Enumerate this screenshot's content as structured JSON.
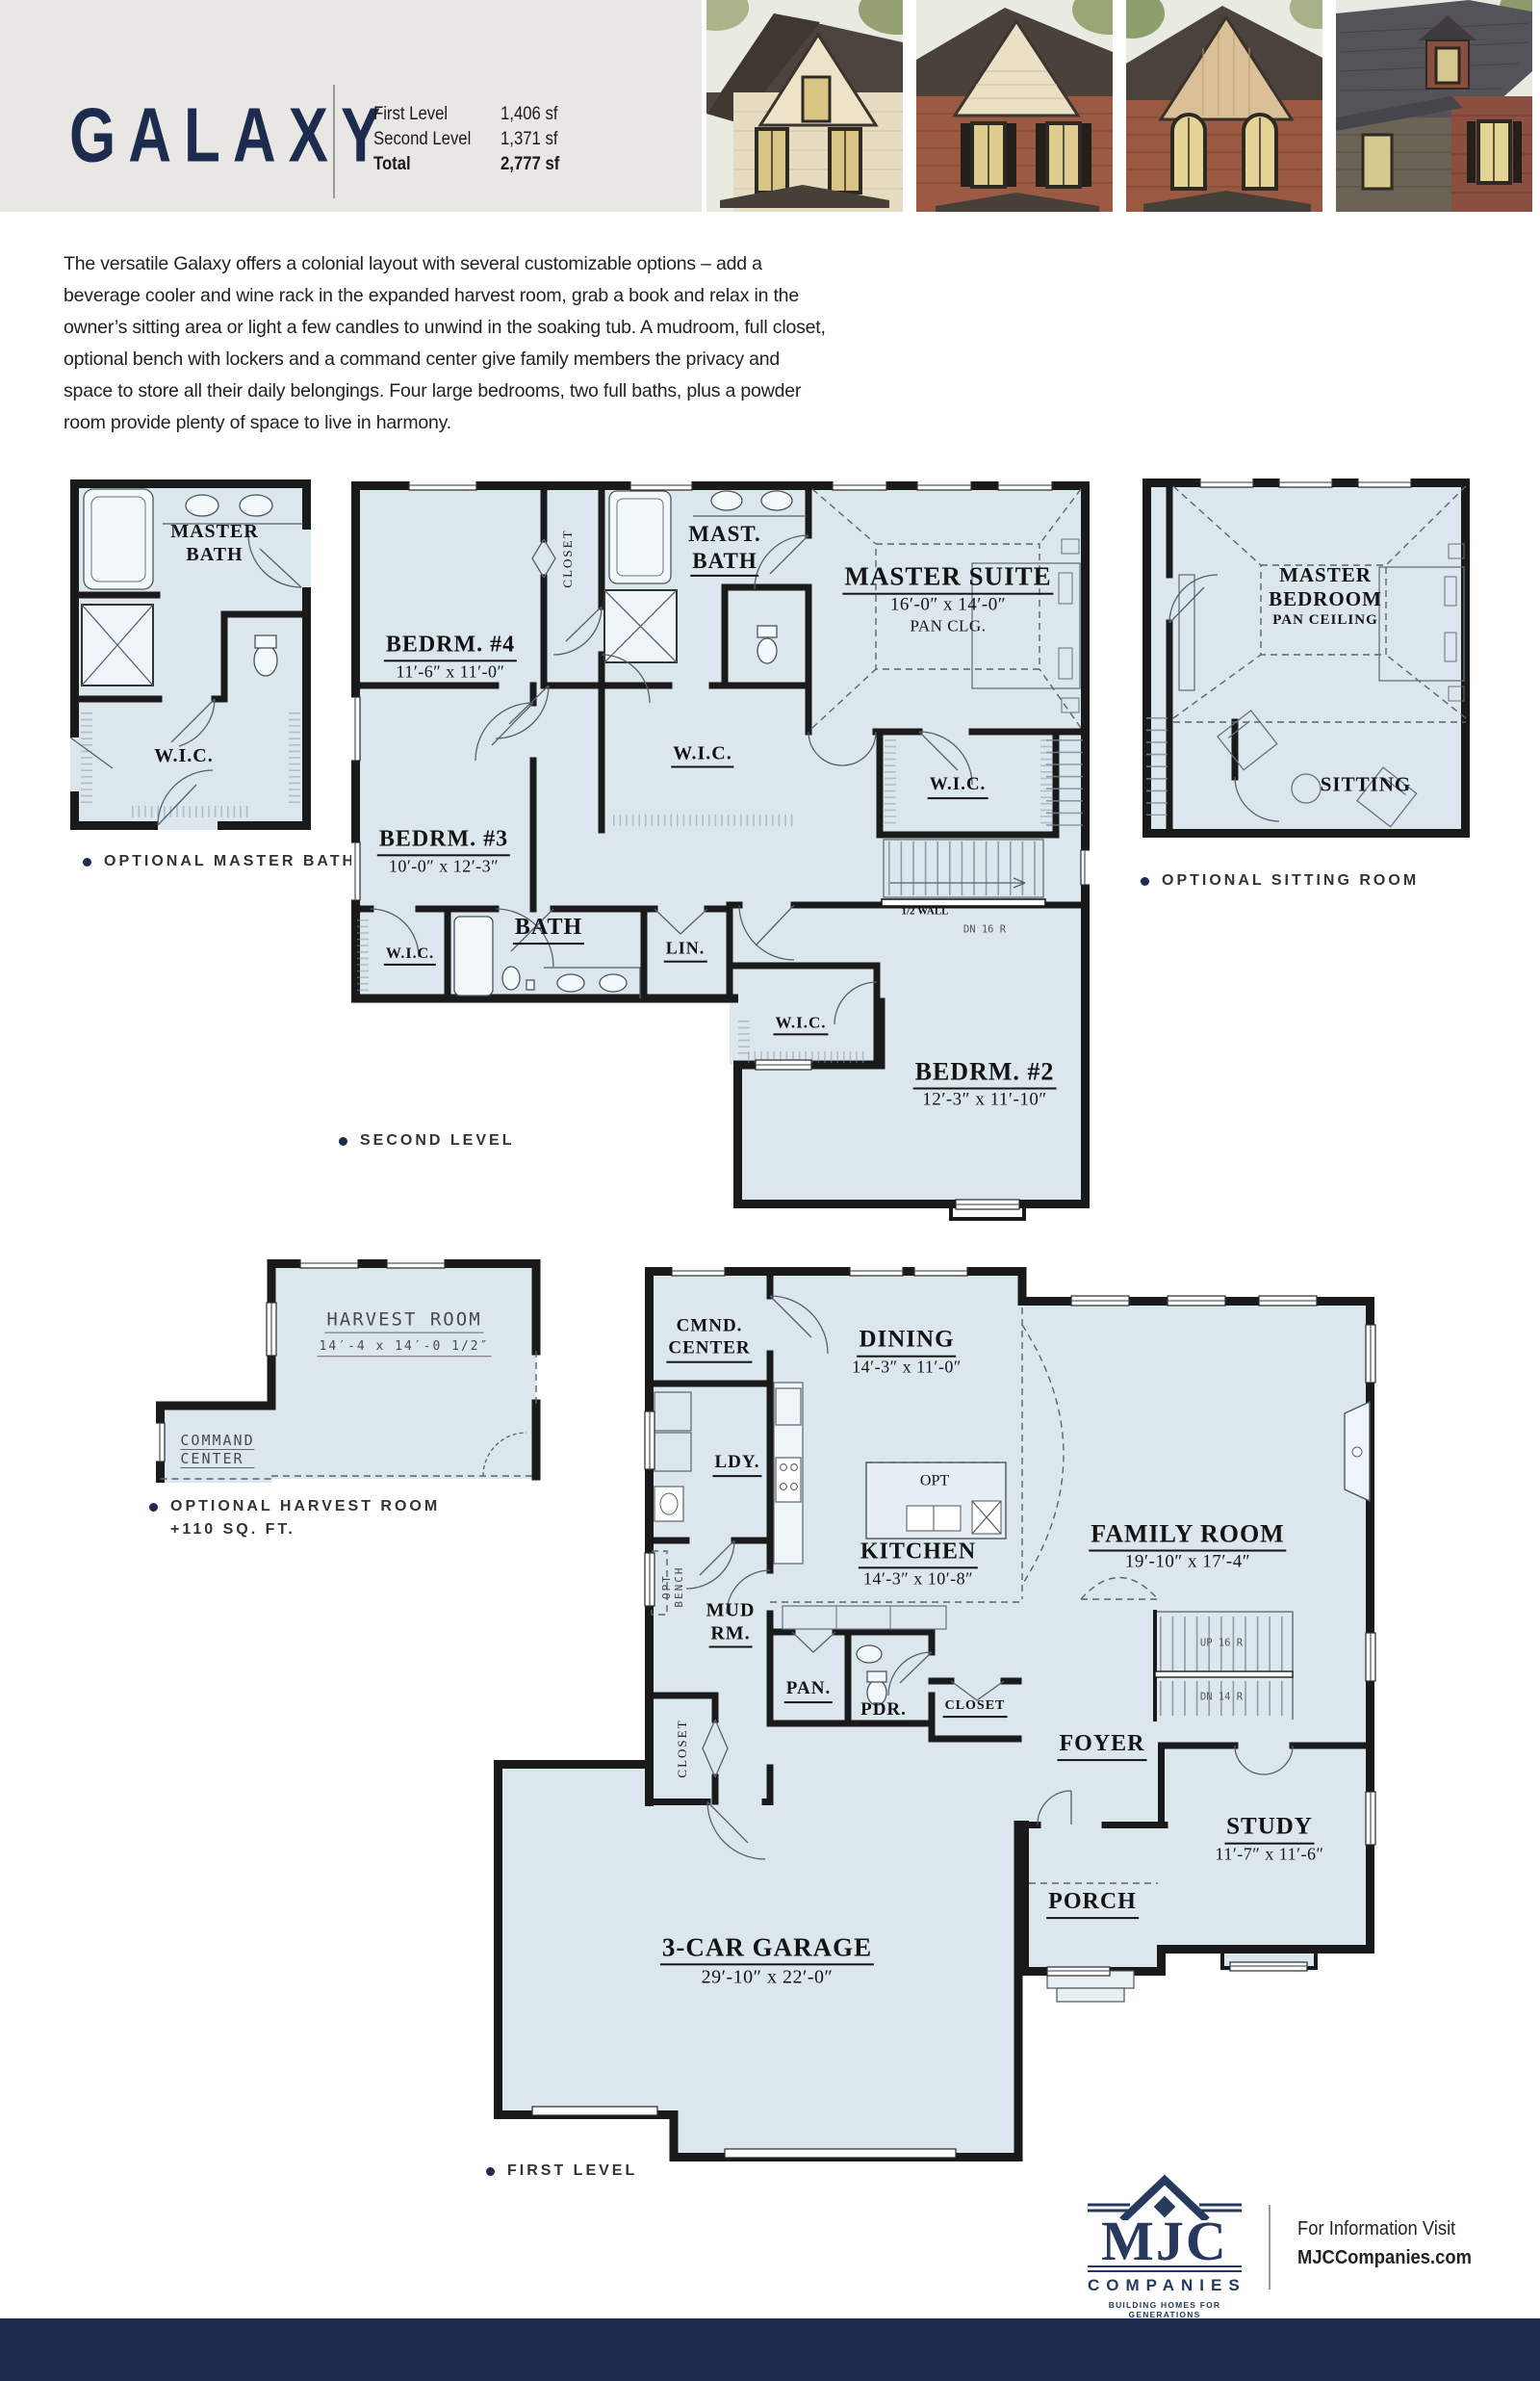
{
  "header": {
    "title": "GALAXY",
    "first_level_label": "First Level",
    "first_level_value": "1,406 sf",
    "second_level_label": "Second Level",
    "second_level_value": "1,371 sf",
    "total_label": "Total",
    "total_value": "2,777 sf"
  },
  "intro": "The versatile Galaxy offers a colonial layout with several customizable options – add a beverage cooler and wine rack in the expanded harvest room, grab a book and relax in the owner’s sitting area or light a few candles to unwind in the soaking tub. A mudroom, full closet, optional bench with lockers and a command center give family members the privacy and space to store all their daily belongings. Four large bedrooms, two full baths, plus a powder room provide plenty of space to live in harmony.",
  "second": {
    "caption": "SECOND LEVEL",
    "opt_bath": {
      "caption": "OPTIONAL MASTER BATH",
      "room1": "MASTER",
      "room2": "BATH",
      "wic": "W.I.C."
    },
    "opt_sitting": {
      "caption": "OPTIONAL SITTING ROOM",
      "room1": "MASTER",
      "room2": "BEDROOM",
      "sub": "PAN CEILING",
      "sitting": "SITTING"
    },
    "main": {
      "bedrm4": "BEDRM. #4",
      "bedrm4_dims": "11′-6″ x 11′-0″",
      "closet": "CLOSET",
      "mast1": "MAST.",
      "mast2": "BATH",
      "suite": "MASTER SUITE",
      "suite_dims": "16′-0″ x 14′-0″",
      "suite_sub": "PAN CLG.",
      "wic": "W.I.C.",
      "bedrm3": "BEDRM. #3",
      "bedrm3_dims": "10′-0″ x 12′-3″",
      "bath": "BATH",
      "lin": "LIN.",
      "half_wall": "1/2 WALL",
      "dn16": "DN 16 R",
      "bedrm2": "BEDRM. #2",
      "bedrm2_dims": "12′-3″ x 11′-10″"
    }
  },
  "first": {
    "caption": "FIRST LEVEL",
    "opt_harvest": {
      "caption1": "OPTIONAL HARVEST ROOM",
      "caption2": "+110 SQ. FT.",
      "room": "HARVEST ROOM",
      "dims": "14′-4 x 14′-0 1/2″",
      "cmd1": "COMMAND",
      "cmd2": "CENTER"
    },
    "main": {
      "cmnd1": "CMND.",
      "cmnd2": "CENTER",
      "dining": "DINING",
      "dining_dims": "14′-3″ x 11′-0″",
      "family": "FAMILY ROOM",
      "family_dims": "19′-10″ x 17′-4″",
      "ldy": "LDY.",
      "opt": "OPT",
      "kitchen": "KITCHEN",
      "kitchen_dims": "14′-3″ x 10′-8″",
      "opt_bench1": "OPT",
      "opt_bench2": "BENCH",
      "mud1": "MUD",
      "mud2": "RM.",
      "closet_v": "CLOSET",
      "pan": "PAN.",
      "pdr": "PDR.",
      "closet_h": "CLOSET",
      "foyer": "FOYER",
      "up16": "UP 16 R",
      "dn14": "DN 14 R",
      "study": "STUDY",
      "study_dims": "11′-7″ x 11′-6″",
      "porch": "PORCH",
      "garage": "3-CAR GARAGE",
      "garage_dims": "29′-10″ x 22′-0″"
    }
  },
  "footer": {
    "logo_text": "MJC",
    "logo_sub": "COMPANIES",
    "logo_tag": "BUILDING HOMES FOR GENERATIONS",
    "info1": "For Information Visit",
    "info2": "MJCCompanies.com"
  },
  "colors": {
    "navy": "#1d2c4e",
    "plan_fill": "#dce7ed",
    "header_gray": "#e8e7e3"
  }
}
